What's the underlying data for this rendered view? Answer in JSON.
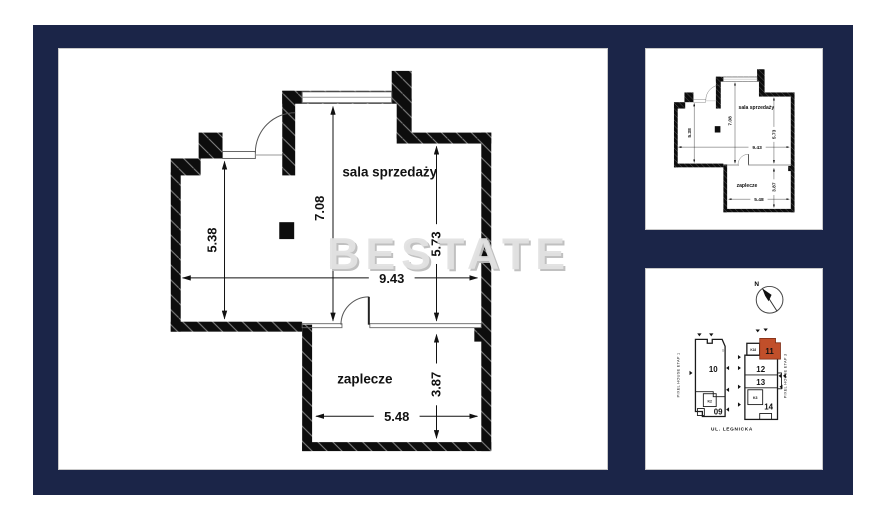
{
  "watermark": "BESTATE",
  "plan": {
    "room_sala": "sala sprzedaży",
    "room_zaplecze": "zaplecze",
    "dim_5_38": "5.38",
    "dim_7_08": "7.08",
    "dim_5_73": "5.73",
    "dim_9_43": "9.43",
    "dim_3_87": "3.87",
    "dim_5_48": "5.48"
  },
  "map": {
    "compass_n": "N",
    "street": "UL. LEGNICKA",
    "etap1": "PIXEL HOUSE ETAP 1",
    "etap3": "PIXEL HOUSE ETAP 3",
    "unit_10": "10",
    "unit_09": "09",
    "unit_11": "11",
    "unit_12": "12",
    "unit_13": "13",
    "unit_14": "14",
    "room_k2": "K2",
    "room_k3": "K3",
    "room_k18": "K18",
    "marker_9": "9"
  },
  "colors": {
    "frame_navy": "#1b2548",
    "panel_white": "#ffffff",
    "wall_black": "#0d0d0d",
    "window_gray": "#777777",
    "highlight_orange": "#c14f2a",
    "watermark_gray": "#d9d9d9"
  }
}
